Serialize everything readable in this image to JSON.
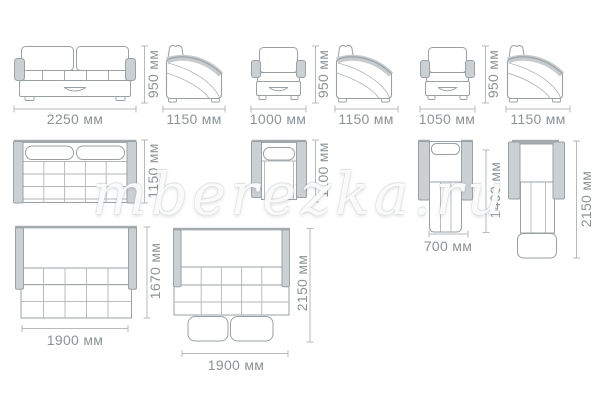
{
  "watermark": "mberezka.ru",
  "dims": {
    "sofa_front_width": "2250 мм",
    "sofa_front_height": "950 мм",
    "sofa_side_depth": "1150 мм",
    "armchair_front_width": "1000 мм",
    "armchair_front_height": "950 мм",
    "armchair_side_depth": "1150 мм",
    "armchair2_front_width": "1050 мм",
    "armchair2_front_height": "950 мм",
    "armchair2_side_depth": "1150 мм",
    "sofa_top_depth": "1150 мм",
    "armchair_top_depth": "1100 мм",
    "armchair_bed_width": "700 мм",
    "armchair_bed_extension_length": "1490 мм",
    "armchair_bed_total_length": "2150 мм",
    "sofa_bed1_width": "1900 мм",
    "sofa_bed1_length": "1670 мм",
    "sofa_bed2_width": "1900 мм",
    "sofa_bed2_length": "2150 мм"
  }
}
